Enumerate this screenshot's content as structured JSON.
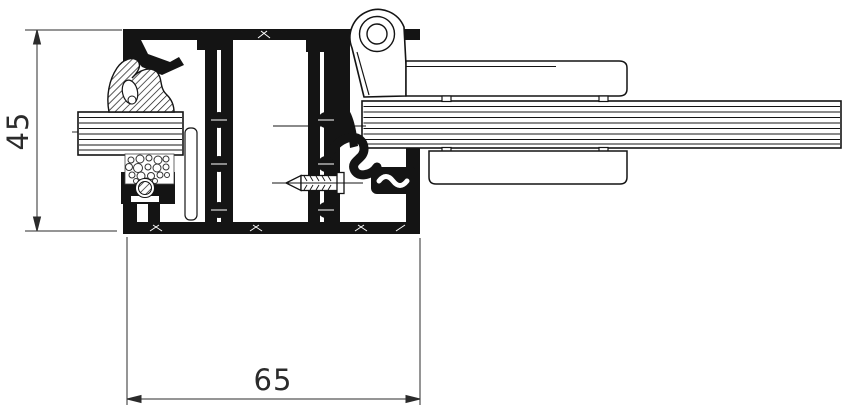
{
  "drawing": {
    "kind": "aluminium-profile-cross-section",
    "colors": {
      "background": "#ffffff",
      "profile_line": "#141414",
      "dimension_line": "#2b2b2b"
    },
    "dimensions": {
      "vertical": {
        "label": "45"
      },
      "horizontal": {
        "label": "65"
      }
    },
    "parts": [
      "frame-profile",
      "sash-profile",
      "hinge-knuckle",
      "hinge-arm-cover",
      "glass-panel-left",
      "sandwich-panel-right",
      "clamp-plate",
      "wedge-gasket",
      "foam-backer",
      "gasket-grommet",
      "glazing-gasket",
      "fixing-screw"
    ]
  }
}
